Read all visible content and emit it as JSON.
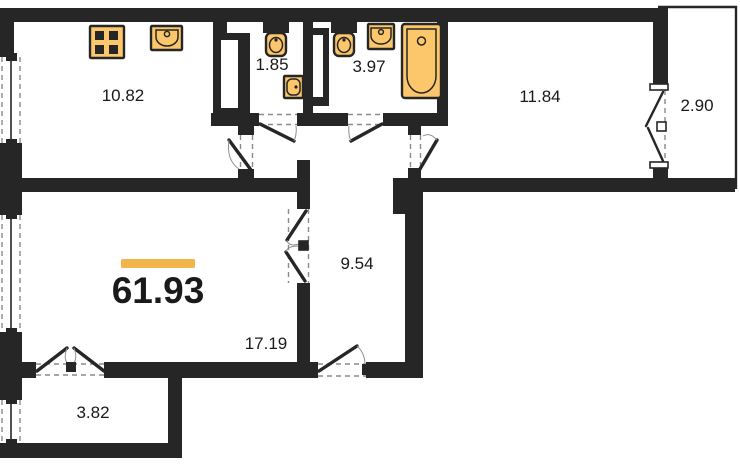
{
  "colors": {
    "wall": "#262626",
    "text": "#1a1a1a",
    "fixture_fill": "#fbc76a",
    "accent_bar": "#f2b54c",
    "dash": "#8a8a8a",
    "background": "#ffffff"
  },
  "plan": {
    "type": "apartment-floor-plan",
    "total_area": "61.93",
    "rooms": [
      {
        "name": "kitchen",
        "area": "10.82"
      },
      {
        "name": "wc",
        "area": "1.85"
      },
      {
        "name": "bathroom",
        "area": "3.97"
      },
      {
        "name": "bedroom",
        "area": "11.84"
      },
      {
        "name": "balcony",
        "area": "2.90"
      },
      {
        "name": "hallway",
        "area": "9.54"
      },
      {
        "name": "living-room",
        "area": "17.19"
      },
      {
        "name": "loggia",
        "area": "3.82"
      }
    ],
    "fixtures": [
      "stove-icon",
      "kitchen-sink-icon",
      "toilet-icon",
      "wash-basin-icon",
      "toilet-icon",
      "wash-basin-icon",
      "bathtub-icon"
    ]
  }
}
